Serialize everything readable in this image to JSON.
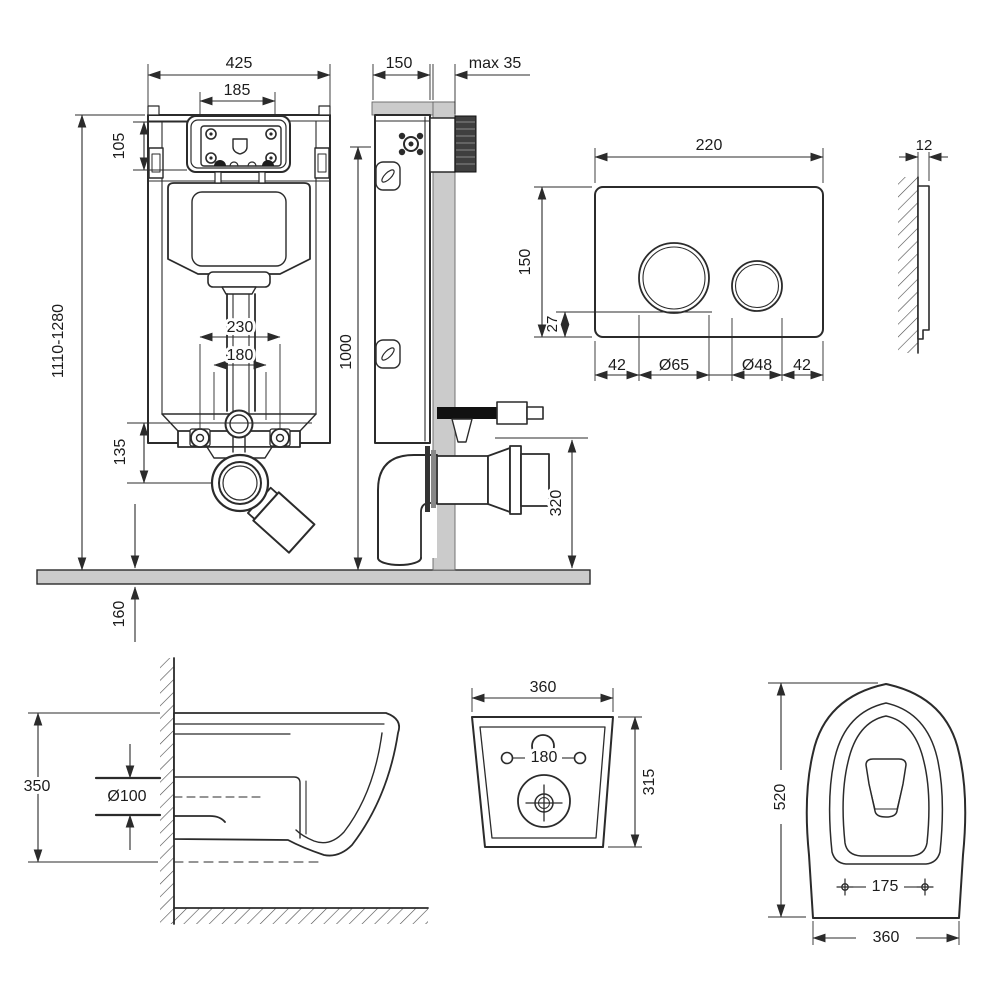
{
  "drawing": {
    "background": "#ffffff",
    "line_color": "#2b2b2b",
    "gray_fill": "#cbcbcb",
    "dark_fill": "#3f3f3f",
    "views": {
      "frame_front": {
        "dims": {
          "width": "425",
          "service_opening_width": "185",
          "service_opening_height": "105",
          "height_range": "1110-1280",
          "bolt_spacing_wide": "230",
          "bolt_spacing_narrow": "180",
          "drain_drop": "135",
          "floor_buildup": "160"
        }
      },
      "frame_side": {
        "dims": {
          "depth": "150",
          "finish_max": "max 35",
          "actuation_height": "1000",
          "drain_height": "320"
        }
      },
      "plate_front": {
        "dims": {
          "width": "220",
          "height": "150",
          "button_bottom": "27",
          "margin_left": "42",
          "big_button": "Ø65",
          "small_button": "Ø48",
          "margin_right": "42"
        }
      },
      "plate_side": {
        "dims": {
          "thickness": "12"
        }
      },
      "bowl_side": {
        "dims": {
          "height": "350",
          "drain": "Ø100"
        }
      },
      "bowl_back": {
        "dims": {
          "width": "360",
          "hole_spacing": "180",
          "height": "315"
        }
      },
      "bowl_top": {
        "dims": {
          "length": "520",
          "seat_hole_spacing": "175",
          "width": "360"
        }
      }
    }
  }
}
